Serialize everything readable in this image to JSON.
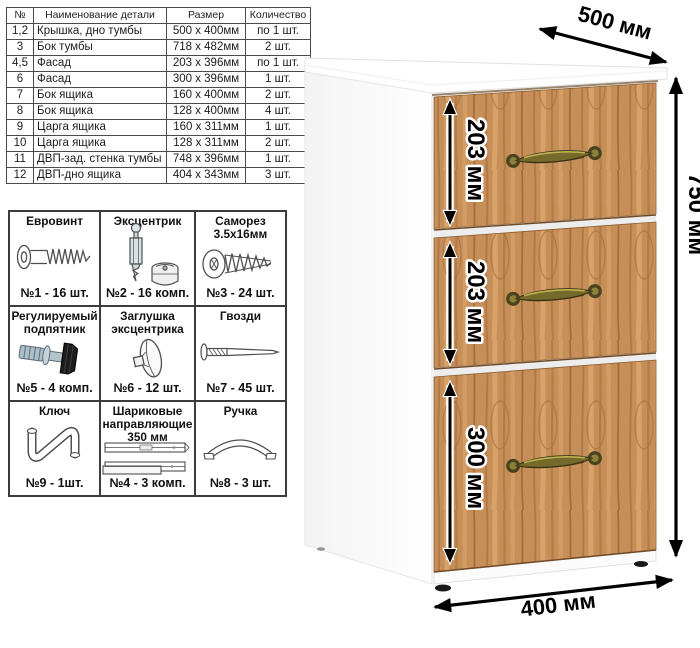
{
  "parts_table": {
    "headers": [
      "№",
      "Наименование детали",
      "Размер",
      "Количество"
    ],
    "rows": [
      [
        "1,2",
        "Крышка, дно тумбы",
        "500 x 400мм",
        "по 1 шт."
      ],
      [
        "3",
        "Бок тумбы",
        "718 x 482мм",
        "2 шт."
      ],
      [
        "4,5",
        "Фасад",
        "203 x 396мм",
        "по 1 шт."
      ],
      [
        "6",
        "Фасад",
        "300 x 396мм",
        "1 шт."
      ],
      [
        "7",
        "Бок ящика",
        "160 x 400мм",
        "2 шт."
      ],
      [
        "8",
        "Бок ящика",
        "128 x 400мм",
        "4 шт."
      ],
      [
        "9",
        "Царга ящика",
        "160 x 311мм",
        "1 шт."
      ],
      [
        "10",
        "Царга ящика",
        "128 x 311мм",
        "2 шт."
      ],
      [
        "11",
        "ДВП-зад. стенка тумбы",
        "748 x 396мм",
        "1 шт."
      ],
      [
        "12",
        "ДВП-дно ящика",
        "404 x 343мм",
        "3 шт."
      ]
    ]
  },
  "hardware": {
    "items": [
      {
        "title": "Евровинт",
        "count": "№1 - 16 шт.",
        "icon": "confirmat-screw-icon"
      },
      {
        "title": "Эксцентрик",
        "count": "№2 - 16 комп.",
        "icon": "cam-lock-icon"
      },
      {
        "title": "Саморез 3.5х16мм",
        "count": "№3 - 24 шт.",
        "icon": "self-tapping-screw-icon"
      },
      {
        "title": "Регулируемый подпятник",
        "count": "№5 - 4 комп.",
        "icon": "adjustable-foot-icon"
      },
      {
        "title": "Заглушка эксцентрика",
        "count": "№6 - 12 шт.",
        "icon": "cam-cap-icon"
      },
      {
        "title": "Гвозди",
        "count": "№7 - 45 шт.",
        "icon": "nail-icon"
      },
      {
        "title": "Ключ",
        "count": "№9 - 1шт.",
        "icon": "hex-key-icon"
      },
      {
        "title": "Шариковые направляющие 350 мм",
        "count": "№4 - 3 комп.",
        "icon": "ball-bearing-slides-icon"
      },
      {
        "title": "Ручка",
        "count": "№8 - 3 шт.",
        "icon": "drawer-pull-icon"
      }
    ]
  },
  "dimensions": {
    "width": "500 мм",
    "height": "750 мм",
    "depth": "400 мм",
    "drawer1": "203 мм",
    "drawer2": "203 мм",
    "drawer3": "300 мм"
  },
  "colors": {
    "wood_base": "#c68e58",
    "wood_dark": "#aa713e",
    "wood_light": "#daa76c",
    "handle_brass": "#766a2a",
    "arrow": "#000000",
    "carcass_white": "#ffffff"
  }
}
